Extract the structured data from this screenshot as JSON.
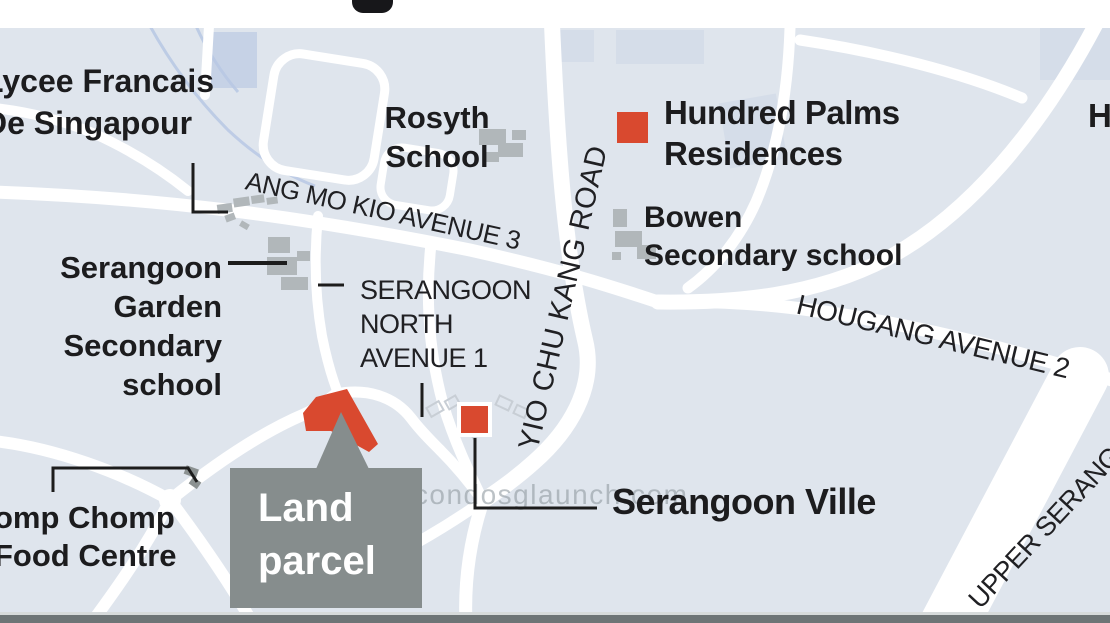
{
  "watermark": "www.condosglaunch.com",
  "places": {
    "lycee": {
      "line1": "Lycee Francais",
      "line2": "De Singapour"
    },
    "rosyth": {
      "line1": "Rosyth",
      "line2": "School"
    },
    "hundred_palms": {
      "line1": "Hundred Palms",
      "line2": "Residences"
    },
    "bowen": {
      "line1": "Bowen",
      "line2": "Secondary school"
    },
    "serangoon_garden": {
      "line1": "Serangoon",
      "line2": "Garden",
      "line3": "Secondary",
      "line4": "school"
    },
    "chomp_chomp": {
      "line1": "omp Chomp",
      "line2": "Food Centre"
    },
    "serangoon_ville": {
      "label": "Serangoon Ville"
    },
    "edge_partial": {
      "label": "H"
    }
  },
  "road_labels": {
    "amk3": "ANG MO KIO AVENUE 3",
    "yck": "YIO CHU KANG ROAD",
    "hougang2": "HOUGANG AVENUE 2",
    "upper_serangoon": "UPPER SERANG",
    "sna1": {
      "line1": "SERANGOON",
      "line2": "NORTH",
      "line3": "AVENUE 1"
    }
  },
  "callout": {
    "land_parcel_line1": "Land",
    "land_parcel_line2": "parcel"
  },
  "markers": {
    "hundred_palms_marker": "red-square",
    "serangoon_ville_marker": "red-square",
    "land_parcel_shape": "red-polygon"
  },
  "colors": {
    "marker_red": "#d9492f",
    "callout_box_gray": "#868d8d",
    "map_background": "#dfe5ed",
    "road_white": "#ffffff",
    "building_gray": "#b1b7ba",
    "text_black": "#1c1c1e",
    "watermark_gray": "#949ea4",
    "bottom_bar_gray": "#6e7576"
  }
}
